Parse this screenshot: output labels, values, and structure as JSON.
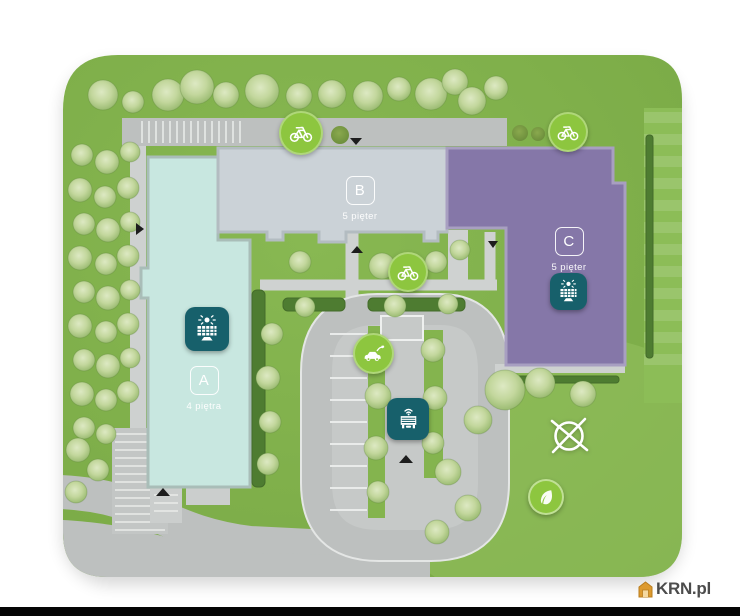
{
  "site": {
    "buildings": [
      {
        "id": "a",
        "label": "A",
        "floors": "4 piętra",
        "color": "#c8e7e0"
      },
      {
        "id": "b",
        "label": "B",
        "floors": "5 pięter",
        "color": "#cbd2d7"
      },
      {
        "id": "c",
        "label": "C",
        "floors": "5 pięter",
        "color": "#8577a8"
      }
    ]
  },
  "colors": {
    "badge_green": "#8dc63f",
    "badge_teal": "#17606b",
    "grass": "#80b04a",
    "road": "#bdc0bf",
    "watermark_house": "#dd9a2f",
    "watermark_text": "#4c4c4c"
  },
  "icons": {
    "bicycle": "green circle + white bicycle",
    "ev_charging": "green circle + white car with charging plug",
    "solar_panel": "teal rounded square + white sun over panel grid",
    "garage_shelter": "teal rounded square + white canopy with antenna",
    "leaf": "green circle + white leaf",
    "compass": "white circle with X cross lines"
  },
  "watermark": {
    "text": "KRN.pl"
  }
}
